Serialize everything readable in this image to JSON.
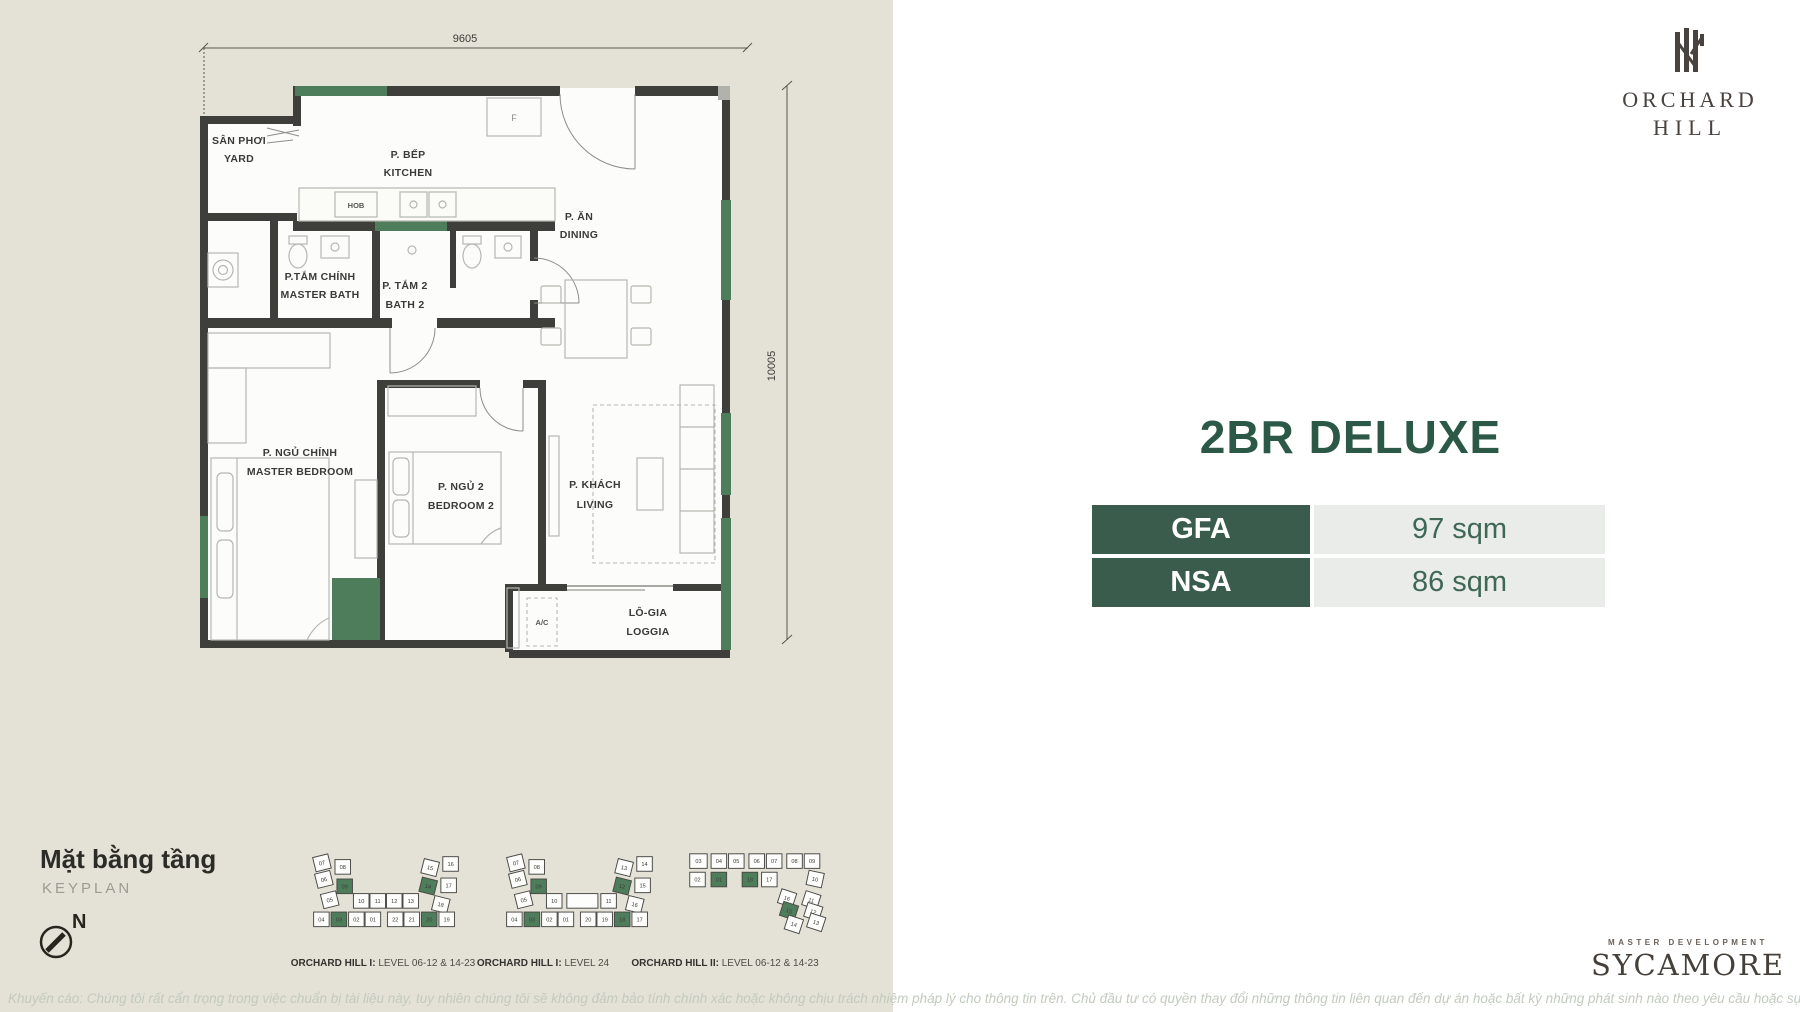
{
  "colors": {
    "bg_left": "#e4e2d6",
    "bg_right": "#ffffff",
    "accent_green": "#4e7d5c",
    "dark_green": "#2c5847",
    "table_header_green": "#3a5c4c",
    "value_cell_gray": "#e9ece9"
  },
  "logo": {
    "line1": "ORCHARD",
    "line2": "HILL"
  },
  "unit": {
    "title": "2BR DELUXE",
    "specs": [
      {
        "label": "GFA",
        "value": "97 sqm"
      },
      {
        "label": "NSA",
        "value": "86 sqm"
      }
    ]
  },
  "floorplan": {
    "dim_width": "9605",
    "dim_height": "10005",
    "rooms": {
      "yard_vi": "SÂN PHƠI",
      "yard_en": "YARD",
      "kitchen_vi": "P. BẾP",
      "kitchen_en": "KITCHEN",
      "dining_vi": "P. ĂN",
      "dining_en": "DINING",
      "master_bath_vi": "P.TẮM CHÍNH",
      "master_bath_en": "MASTER BATH",
      "bath2_vi": "P. TẮM 2",
      "bath2_en": "BATH 2",
      "master_bed_vi": "P. NGỦ CHÍNH",
      "master_bed_en": "MASTER BEDROOM",
      "bed2_vi": "P. NGỦ 2",
      "bed2_en": "BEDROOM 2",
      "living_vi": "P. KHÁCH",
      "living_en": "LIVING",
      "loggia_vi": "LÔ-GIA",
      "loggia_en": "LOGGIA",
      "ac": "A/C",
      "hob": "HOB",
      "fridge": "F"
    }
  },
  "keyplan_section": {
    "title_vi": "Mặt bằng tầng",
    "title_en": "KEYPLAN",
    "north": "N"
  },
  "keyplans": [
    {
      "caption_bold": "ORCHARD HILL I:",
      "caption_rest": " LEVEL 06-12 & 14-23",
      "units": [
        {
          "n": "07",
          "x": 20,
          "y": 12,
          "r": -14
        },
        {
          "n": "08",
          "x": 43,
          "y": 14
        },
        {
          "n": "06",
          "x": 22,
          "y": 29,
          "r": -14
        },
        {
          "n": "09",
          "x": 45,
          "y": 34,
          "g": 1
        },
        {
          "n": "05",
          "x": 28,
          "y": 50,
          "r": -14
        },
        {
          "n": "15",
          "x": 135,
          "y": 13,
          "r": 14
        },
        {
          "n": "16",
          "x": 154,
          "y": 11
        },
        {
          "n": "14",
          "x": 133,
          "y": 32,
          "r": 14,
          "g": 1
        },
        {
          "n": "17",
          "x": 152,
          "y": 33
        },
        {
          "n": "18",
          "x": 146,
          "y": 51,
          "r": 14
        },
        {
          "n": "10",
          "x": 62,
          "y": 49
        },
        {
          "n": "11",
          "x": 79,
          "y": 49
        },
        {
          "n": "12",
          "x": 96,
          "y": 49
        },
        {
          "n": "13",
          "x": 113,
          "y": 49
        },
        {
          "n": "04",
          "x": 21,
          "y": 68
        },
        {
          "n": "03",
          "x": 39,
          "y": 68,
          "g": 1
        },
        {
          "n": "02",
          "x": 57,
          "y": 68
        },
        {
          "n": "01",
          "x": 74,
          "y": 68
        },
        {
          "n": "22",
          "x": 97,
          "y": 68
        },
        {
          "n": "21",
          "x": 114,
          "y": 68
        },
        {
          "n": "20",
          "x": 132,
          "y": 68,
          "g": 1
        },
        {
          "n": "19",
          "x": 150,
          "y": 68
        }
      ]
    },
    {
      "caption_bold": "ORCHARD HILL I:",
      "caption_rest": " LEVEL 24",
      "units": [
        {
          "n": "07",
          "x": 21,
          "y": 12,
          "r": -14
        },
        {
          "n": "08",
          "x": 44,
          "y": 14
        },
        {
          "n": "06",
          "x": 23,
          "y": 29,
          "r": -14
        },
        {
          "n": "09",
          "x": 46,
          "y": 34,
          "g": 1
        },
        {
          "n": "05",
          "x": 29,
          "y": 50,
          "r": -14
        },
        {
          "n": "13",
          "x": 136,
          "y": 13,
          "r": 14
        },
        {
          "n": "14",
          "x": 155,
          "y": 11
        },
        {
          "n": "12",
          "x": 134,
          "y": 32,
          "r": 14,
          "g": 1
        },
        {
          "n": "15",
          "x": 153,
          "y": 33
        },
        {
          "n": "16",
          "x": 147,
          "y": 51,
          "r": 14
        },
        {
          "n": "10",
          "x": 62,
          "y": 49
        },
        {
          "n": "",
          "x": 83,
          "y": 49,
          "w": 32
        },
        {
          "n": "11",
          "x": 118,
          "y": 49
        },
        {
          "n": "04",
          "x": 21,
          "y": 68
        },
        {
          "n": "03",
          "x": 39,
          "y": 68,
          "g": 1
        },
        {
          "n": "02",
          "x": 57,
          "y": 68
        },
        {
          "n": "01",
          "x": 74,
          "y": 68
        },
        {
          "n": "20",
          "x": 97,
          "y": 68
        },
        {
          "n": "19",
          "x": 114,
          "y": 68
        },
        {
          "n": "18",
          "x": 132,
          "y": 68,
          "g": 1
        },
        {
          "n": "17",
          "x": 150,
          "y": 68
        }
      ]
    },
    {
      "caption_bold": "ORCHARD HILL II:",
      "caption_rest": " LEVEL 06-12 & 14-23",
      "units": [
        {
          "n": "03",
          "x": 9,
          "y": 8,
          "w": 18
        },
        {
          "n": "04",
          "x": 31,
          "y": 8
        },
        {
          "n": "05",
          "x": 49,
          "y": 8
        },
        {
          "n": "06",
          "x": 70,
          "y": 8
        },
        {
          "n": "07",
          "x": 88,
          "y": 8
        },
        {
          "n": "08",
          "x": 109,
          "y": 8
        },
        {
          "n": "09",
          "x": 127,
          "y": 8
        },
        {
          "n": "02",
          "x": 9,
          "y": 27
        },
        {
          "n": "01",
          "x": 31,
          "y": 27,
          "g": 1
        },
        {
          "n": "18",
          "x": 63,
          "y": 27,
          "g": 1
        },
        {
          "n": "17",
          "x": 83,
          "y": 27
        },
        {
          "n": "10",
          "x": 132,
          "y": 25,
          "r": 12
        },
        {
          "n": "16",
          "x": 104,
          "y": 44,
          "r": 18
        },
        {
          "n": "11",
          "x": 129,
          "y": 46,
          "r": 18
        },
        {
          "n": "15",
          "x": 106,
          "y": 57,
          "r": 18,
          "g": 1
        },
        {
          "n": "12",
          "x": 131,
          "y": 58,
          "r": 18
        },
        {
          "n": "14",
          "x": 111,
          "y": 71,
          "r": 18
        },
        {
          "n": "13",
          "x": 134,
          "y": 69,
          "r": 18
        }
      ]
    }
  ],
  "master_dev": {
    "label": "MASTER DEVELOPMENT",
    "brand": "SYCAMORE"
  },
  "disclaimer": "Khuyến cáo: Chúng tôi rất cẩn trọng trong việc chuẩn bị tài liệu này, tuy nhiên chúng tôi sẽ không đảm bảo tính chính xác hoặc không chịu trách nhiệm pháp lý cho thông tin trên. Chủ đầu tư có quyền thay đổi những thông tin liên quan đến dự án hoặc bất kỳ những phát sinh nào theo yêu cầu hoặc sự chấp thuận của cơ quan nhà nước có thẩm quyền"
}
